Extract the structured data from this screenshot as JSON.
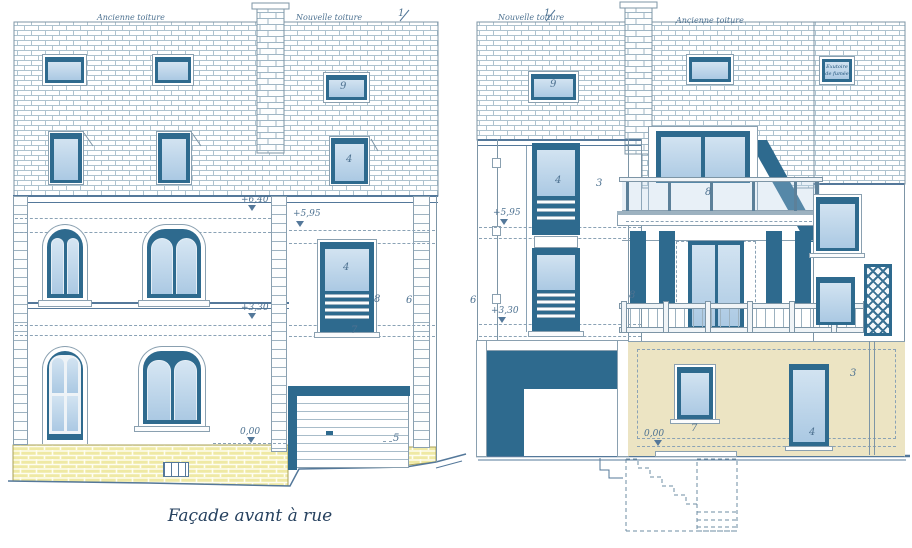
{
  "caption": "Façade avant à rue",
  "left": {
    "old_roof": "Ancienne toiture",
    "new_roof": "Nouvelle toiture",
    "roof_num": "1",
    "lv_eave": "+6,40",
    "lv_annex": "+5,95",
    "lv_floor": "+3,30",
    "lv_ground": "0,00",
    "c_skylight": "9",
    "c_dormer": "4",
    "c_door": "4",
    "c_railing": "8",
    "c_sill": "7",
    "c_sidewall": "6",
    "c_garage": "5"
  },
  "right": {
    "new_roof": "Nouvelle toiture",
    "roof_num": "1",
    "old_roof": "Ancienne toiture",
    "vent_l1": "Exutoire",
    "vent_l2": "de fumée",
    "lv_upper": "+5,95",
    "lv_floor": "+3,30",
    "lv_ground": "0,00",
    "c_skylight": "9",
    "c_window": "4",
    "c_wall_up": "3",
    "c_railing": "8",
    "c_sidewall": "6",
    "c_balcony": "8",
    "c_wall_gf": "3",
    "c_win7": "7",
    "c_door4": "4"
  }
}
